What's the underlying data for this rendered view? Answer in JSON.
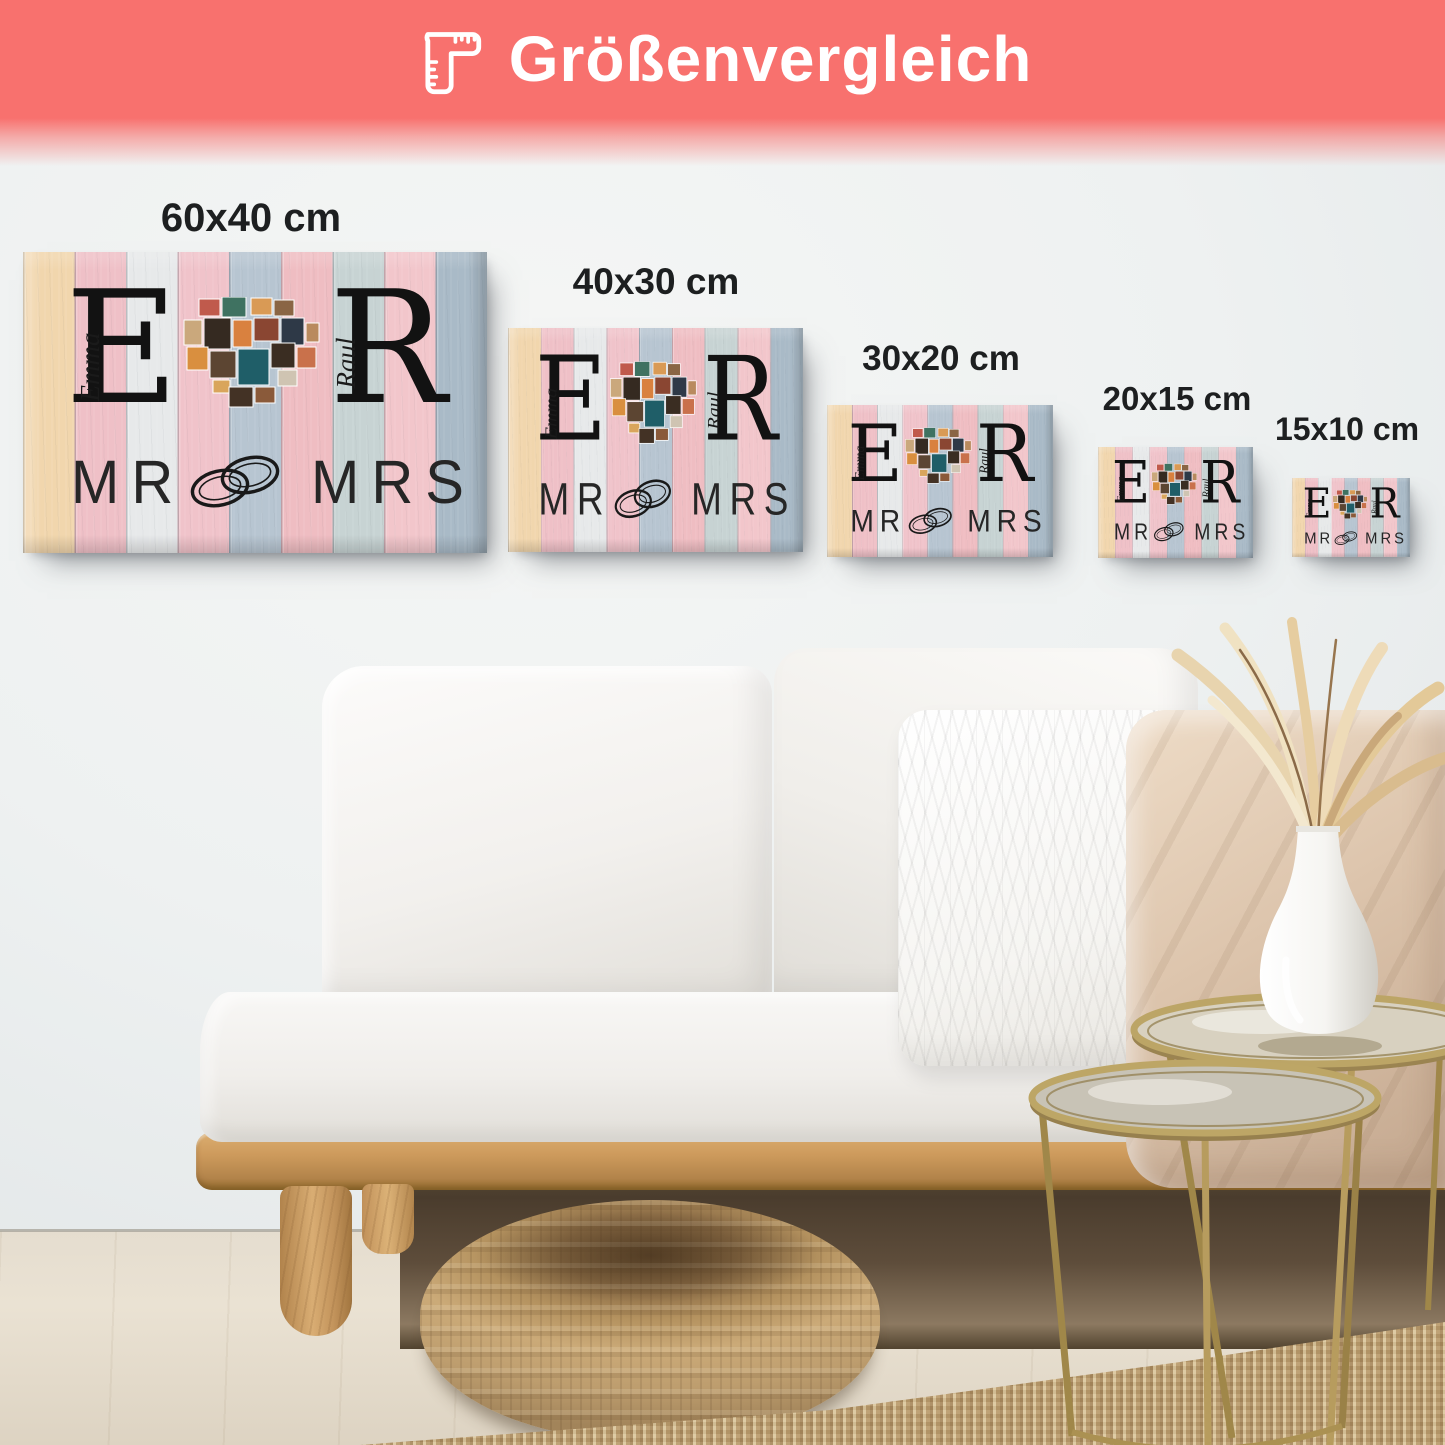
{
  "header": {
    "title": "Größenvergleich",
    "icon": "ruler-corner-icon",
    "accent_color": "#f8716e",
    "text_color": "#ffffff"
  },
  "size_labels": [
    "60x40 cm",
    "40x30 cm",
    "30x20 cm",
    "20x15 cm",
    "15x10 cm"
  ],
  "artwork": {
    "initial_left": "E",
    "name_left": "Emma",
    "initial_right": "R",
    "name_right": "Raul",
    "caption_left": "MR",
    "caption_right": "MRS",
    "rings_icon": "wedding-rings-icon",
    "collage_icon": "heart-photo-collage",
    "plank_colors": [
      "#f1d6ad",
      "#efc0c7",
      "#e7e9ea",
      "#f0c3ca",
      "#b7c5d1",
      "#efbdc2",
      "#c7d3d3",
      "#f2c6cb",
      "#a9bac7"
    ],
    "collage_colors": [
      "#c05a4c",
      "#3f7261",
      "#d99a55",
      "#8a6544",
      "#caa87c",
      "#352a21",
      "#d9813f",
      "#8a4632",
      "#2e3947",
      "#b98a5e",
      "#d98f3f",
      "#5c4532",
      "#1f5e68",
      "#3a2d22",
      "#c9714b",
      "#d9a55c",
      "#cfc4b2",
      "#433225",
      "#8a5a3a",
      "#b7936a"
    ]
  },
  "scene": {
    "wall_color": "#e9eced",
    "floor_color": "#e5ddcf",
    "sofa_color": "#f3f1ee",
    "wood_color": "#c9995c",
    "rug_color": "#c0a478",
    "table_color": "#b49a60"
  }
}
